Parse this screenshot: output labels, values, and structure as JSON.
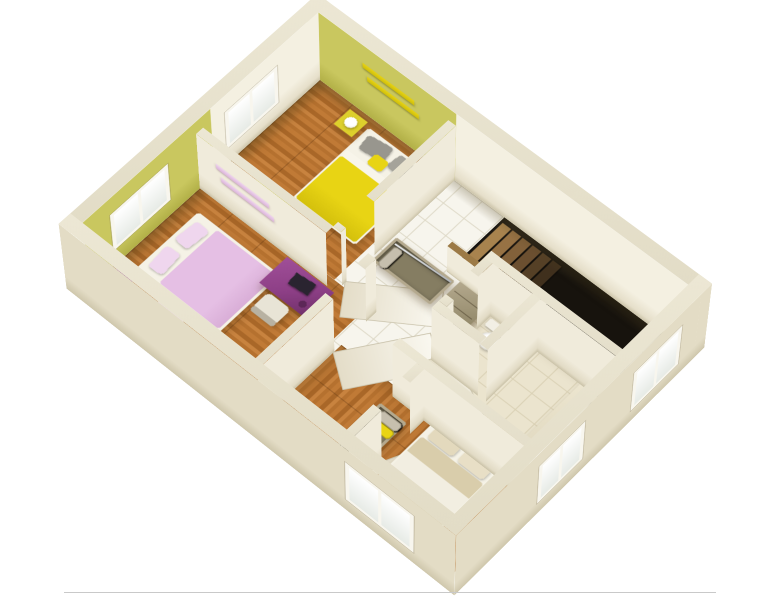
{
  "scene": {
    "background": "#ffffff",
    "baseline_color": "#c9c9c9"
  },
  "rooms": [
    "bedroom-yellow",
    "bedroom-pink",
    "master-bedroom",
    "dressing-area",
    "hallway",
    "wc",
    "bathroom",
    "stairwell"
  ],
  "palette": {
    "page_bg": "#ffffff",
    "baseline": "#c9c9c9",
    "wall_cream_top": "#ece7d4",
    "wall_cream_face": "#f4f0e1",
    "wall_exterior": "#e3dcc5",
    "wall_exterior_dark": "#cfc7ac",
    "wall_green": "#c9c75f",
    "wall_green_dark": "#b2b047",
    "floor_wood_light": "#c8833f",
    "floor_wood_mid": "#b5712f",
    "floor_wood_light2": "#c07a36",
    "floor_wood_dark": "#a96728",
    "floor_tile": "#f7f5ed",
    "floor_tile_grout": "#ddd8c6",
    "floor_bath": "#ebe4ce",
    "floor_bath_grout": "#d9d0b4",
    "void_dark": "#17130d",
    "accent_yellow": "#e8d414",
    "accent_yellow_deep": "#d4c00c",
    "accent_green_dresser": "#c9c43e",
    "accent_pink": "#e5bfe4",
    "accent_pink_light": "#efd6ee",
    "accent_purple": "#8d3f86",
    "accent_purple_dark": "#6e2f68",
    "taupe": "#b4a98e",
    "taupe_in": "#857d62",
    "rail_wood": "#9c7a46",
    "linen_tan": "#d9cdab",
    "linen_white": "#f2eee1",
    "chair_light": "#e8e4d6",
    "chair_dark": "#b8b2a2"
  },
  "garment_colors": {
    "yellow": "#e9d414",
    "gray": "#c6bfae",
    "white": "#f4f1e6",
    "dkgray": "#8f8a75",
    "orange": "#dfa21d",
    "olive": "#b8b145"
  },
  "wardrobes": {
    "g1": [
      "yellow",
      "gray",
      "white",
      "dkgray",
      "olive",
      "orange",
      "white",
      "gray",
      "dkgray",
      "white",
      "gray"
    ],
    "g2a": [
      "white",
      "gray",
      "yellow",
      "dkgray",
      "white",
      "olive",
      "gray",
      "white"
    ],
    "g2b": [
      "yellow",
      "white",
      "gray",
      "orange",
      "dkgray",
      "white",
      "yellow",
      "gray"
    ]
  },
  "stairs": {
    "step_colors": [
      "#a8834e",
      "#977244",
      "#82613a",
      "#6b4f30",
      "#554026",
      "#40301d"
    ]
  }
}
